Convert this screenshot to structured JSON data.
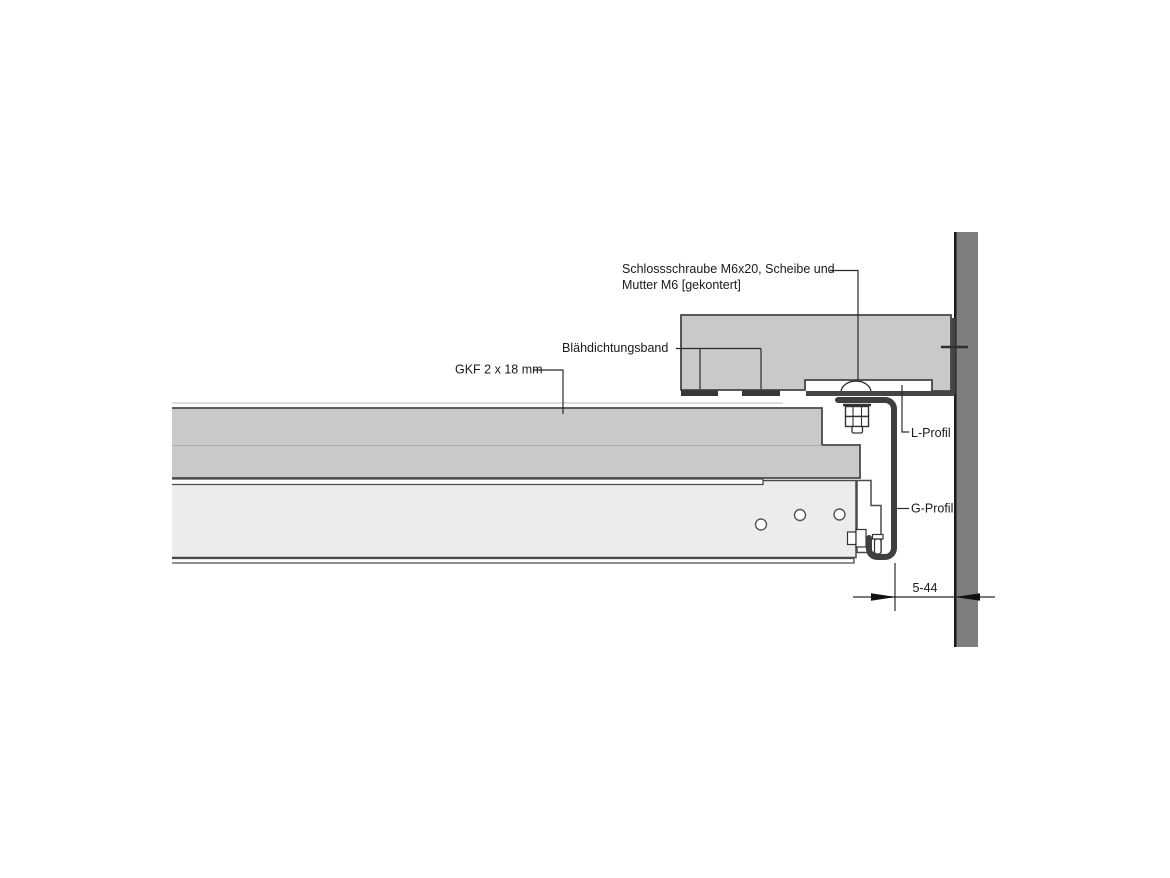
{
  "drawing": {
    "labels": {
      "bolt_line1": "Schlossschraube M6x20, Scheibe und",
      "bolt_line2": "Mutter M6 [gekontert]",
      "sealing_tape": "Blähdichtungsband",
      "board": "GKF 2 x 18 mm",
      "l_profile": "L-Profil",
      "g_profile": "G-Profil",
      "dimension": "5-44"
    },
    "colors": {
      "wall": "#7e7e7e",
      "wall_edge": "#1a1a1a",
      "block": "#c9c9c9",
      "board": "#c9c9c9",
      "panel": "#ececec",
      "tape": "#383838",
      "l_profile_stroke": "#454545",
      "g_profile_stroke": "#3f3f3f",
      "leader": "#2b2b2b",
      "text": "#1a1a1a",
      "arrow": "#111111"
    }
  }
}
